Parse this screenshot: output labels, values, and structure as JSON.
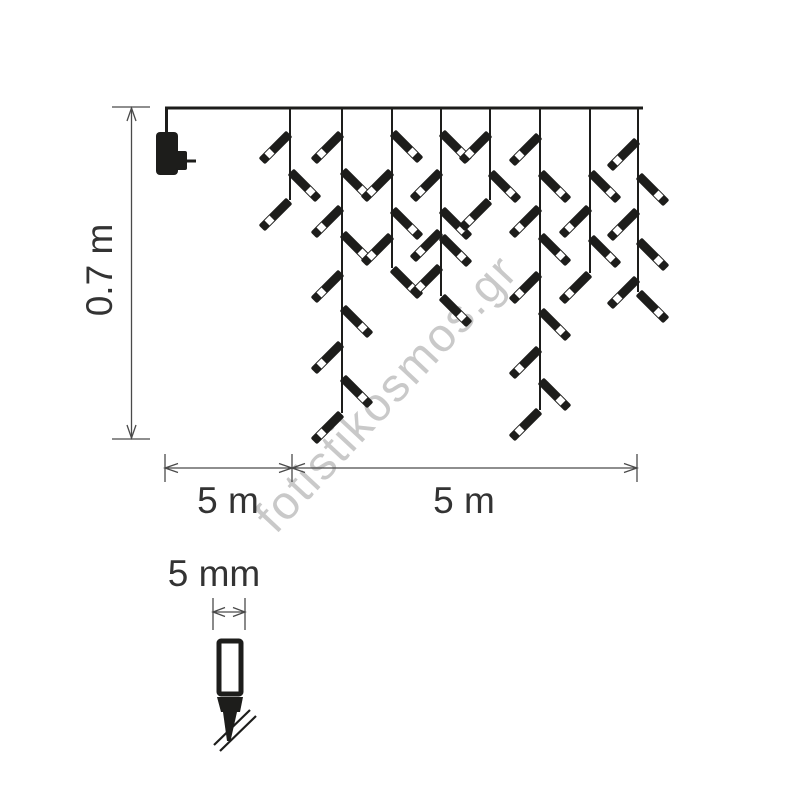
{
  "diagram": {
    "type": "icicle-christmas-lights-dimension-drawing",
    "colors": {
      "line": "#1d1d1b",
      "dim": "#4a4a4a",
      "text": "#333333",
      "watermark": "#c9c9c9",
      "background": "#ffffff"
    },
    "watermark": {
      "text": "fotistikosmos.gr"
    },
    "dimensions": {
      "height": {
        "label": "0.7 m"
      },
      "lead": {
        "label": "5 m"
      },
      "span": {
        "label": "5 m"
      },
      "bulb_width": {
        "label": "5 mm"
      }
    },
    "wire": {
      "x1": 165,
      "x2": 643,
      "y": 108
    },
    "adapter": {
      "name": "power-adapter"
    },
    "strands": [
      {
        "x": 290,
        "bottom": 200,
        "bulbs": [
          {
            "y": 133,
            "dir": "left"
          },
          {
            "y": 171,
            "dir": "right"
          },
          {
            "y": 200,
            "dir": "left"
          }
        ]
      },
      {
        "x": 342,
        "bottom": 413,
        "bulbs": [
          {
            "y": 133,
            "dir": "left"
          },
          {
            "y": 170,
            "dir": "right"
          },
          {
            "y": 207,
            "dir": "left"
          },
          {
            "y": 233,
            "dir": "right"
          },
          {
            "y": 272,
            "dir": "left"
          },
          {
            "y": 307,
            "dir": "right"
          },
          {
            "y": 343,
            "dir": "left"
          },
          {
            "y": 377,
            "dir": "right"
          },
          {
            "y": 413,
            "dir": "left"
          }
        ]
      },
      {
        "x": 392,
        "bottom": 268,
        "bulbs": [
          {
            "y": 132,
            "dir": "right"
          },
          {
            "y": 171,
            "dir": "left"
          },
          {
            "y": 209,
            "dir": "right"
          },
          {
            "y": 235,
            "dir": "left"
          },
          {
            "y": 268,
            "dir": "right"
          }
        ]
      },
      {
        "x": 441,
        "bottom": 296,
        "bulbs": [
          {
            "y": 132,
            "dir": "right"
          },
          {
            "y": 171,
            "dir": "left"
          },
          {
            "y": 209,
            "dir": "right"
          },
          {
            "y": 231,
            "dir": "left"
          },
          {
            "y": 236,
            "dir": "right"
          },
          {
            "y": 266,
            "dir": "left"
          },
          {
            "y": 296,
            "dir": "right"
          }
        ]
      },
      {
        "x": 490,
        "bottom": 200,
        "bulbs": [
          {
            "y": 133,
            "dir": "left"
          },
          {
            "y": 172,
            "dir": "right"
          },
          {
            "y": 200,
            "dir": "left"
          }
        ]
      },
      {
        "x": 540,
        "bottom": 410,
        "bulbs": [
          {
            "y": 135,
            "dir": "left"
          },
          {
            "y": 172,
            "dir": "right"
          },
          {
            "y": 207,
            "dir": "left"
          },
          {
            "y": 235,
            "dir": "right"
          },
          {
            "y": 273,
            "dir": "left"
          },
          {
            "y": 310,
            "dir": "right"
          },
          {
            "y": 348,
            "dir": "left"
          },
          {
            "y": 380,
            "dir": "right"
          },
          {
            "y": 410,
            "dir": "left"
          }
        ]
      },
      {
        "x": 590,
        "bottom": 273,
        "bulbs": [
          {
            "y": 172,
            "dir": "right"
          },
          {
            "y": 207,
            "dir": "left"
          },
          {
            "y": 237,
            "dir": "right"
          },
          {
            "y": 273,
            "dir": "left"
          }
        ]
      },
      {
        "x": 638,
        "bottom": 292,
        "bulbs": [
          {
            "y": 140,
            "dir": "left"
          },
          {
            "y": 175,
            "dir": "right"
          },
          {
            "y": 210,
            "dir": "left"
          },
          {
            "y": 240,
            "dir": "right"
          },
          {
            "y": 278,
            "dir": "left"
          },
          {
            "y": 292,
            "dir": "right"
          }
        ]
      }
    ],
    "bulb": {
      "rod_length": 39,
      "rod_width": 9,
      "window_size": 7,
      "window_offset": 25.5
    }
  }
}
